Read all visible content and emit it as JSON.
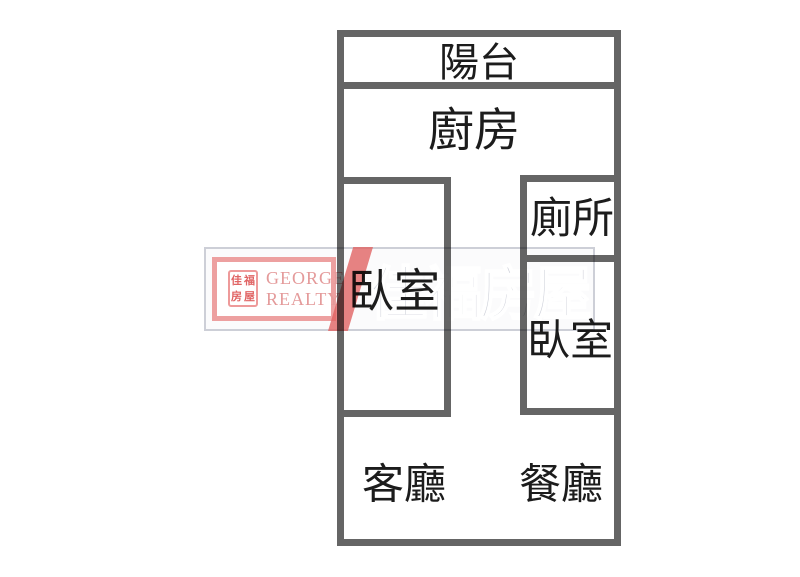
{
  "page": {
    "background_color": "#ffffff",
    "type": "real-estate floor plan image"
  },
  "floorplan": {
    "wall_color": "#656565",
    "label_color": "#1c1c1c",
    "rooms": [
      {
        "id": "balcony",
        "label": "陽台"
      },
      {
        "id": "kitchen",
        "label": "廚房"
      },
      {
        "id": "toilet",
        "label": "廁所"
      },
      {
        "id": "bedroom-left",
        "label": "臥室"
      },
      {
        "id": "bedroom-right",
        "label": "臥室"
      },
      {
        "id": "living-room",
        "label": "客廳"
      },
      {
        "id": "dining-room",
        "label": "餐廳"
      }
    ]
  },
  "watermark": {
    "brand_name_cjk": "佳福房屋",
    "logo": {
      "line1": "GEORGE",
      "line2": "REALTY",
      "seal_chars": [
        "佳",
        "福",
        "房",
        "屋"
      ]
    },
    "colors": {
      "red": "#e06060",
      "pink_border": "#eda0a0",
      "gray_text": "#c9ccd6",
      "frame_gray": "#cdcfd7"
    }
  }
}
